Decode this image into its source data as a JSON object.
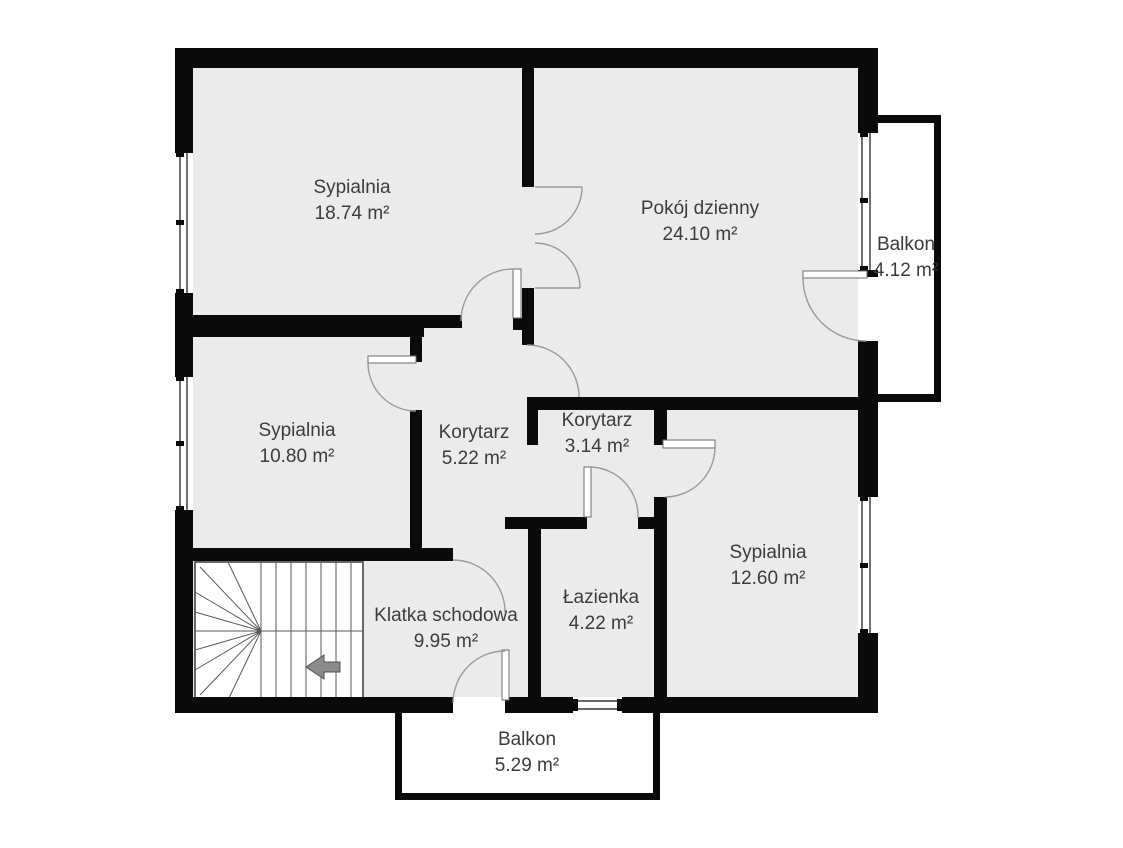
{
  "floorplan": {
    "rooms": [
      {
        "name": "Sypialnia",
        "area": "18.74 m²"
      },
      {
        "name": "Pokój dzienny",
        "area": "24.10 m²"
      },
      {
        "name": "Balkon",
        "area": "4.12 m²"
      },
      {
        "name": "Sypialnia",
        "area": "10.80 m²"
      },
      {
        "name": "Korytarz",
        "area": "5.22 m²"
      },
      {
        "name": "Korytarz",
        "area": "3.14 m²"
      },
      {
        "name": "Sypialnia",
        "area": "12.60 m²"
      },
      {
        "name": "Łazienka",
        "area": "4.22 m²"
      },
      {
        "name": "Klatka schodowa",
        "area": "9.95 m²"
      },
      {
        "name": "Balkon",
        "area": "5.29 m²"
      }
    ],
    "colors": {
      "background": "#ffffff",
      "room_fill": "#ebebeb",
      "wall": "#0a0a0a",
      "door_arc": "#9a9a9a",
      "window_line": "#333333",
      "label_text": "#3c3c3c",
      "stair_arrow": "#8c8c8c"
    }
  }
}
